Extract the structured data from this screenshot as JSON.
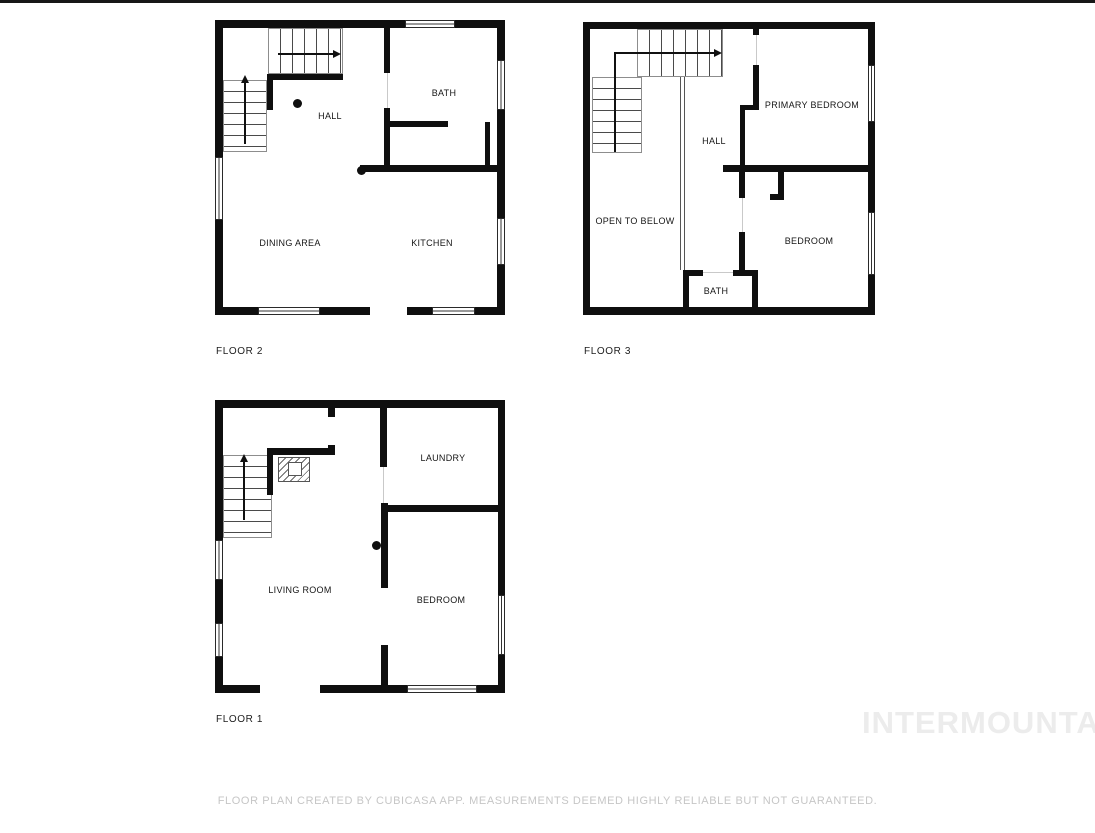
{
  "watermark": {
    "text": "INTERMOUNTAIN",
    "color": "#ececec"
  },
  "footer": {
    "disclaimer": "FLOOR PLAN CREATED BY CUBICASA APP. MEASUREMENTS DEEMED HIGHLY RELIABLE BUT NOT GUARANTEED."
  },
  "colors": {
    "wall": "#0f0f0f",
    "label_text": "#161616",
    "footer_text": "#c6c6c6",
    "top_bar": "#171717"
  },
  "floors": [
    {
      "id": "floor-2",
      "label": "FLOOR 2",
      "rooms": [
        {
          "label": "HALL"
        },
        {
          "label": "BATH"
        },
        {
          "label": "DINING AREA"
        },
        {
          "label": "KITCHEN"
        }
      ]
    },
    {
      "id": "floor-3",
      "label": "FLOOR 3",
      "rooms": [
        {
          "label": "HALL"
        },
        {
          "label": "PRIMARY BEDROOM"
        },
        {
          "label": "OPEN TO BELOW"
        },
        {
          "label": "BEDROOM"
        },
        {
          "label": "BATH"
        }
      ]
    },
    {
      "id": "floor-1",
      "label": "FLOOR 1",
      "rooms": [
        {
          "label": "LAUNDRY"
        },
        {
          "label": "LIVING ROOM"
        },
        {
          "label": "BEDROOM"
        }
      ]
    }
  ]
}
